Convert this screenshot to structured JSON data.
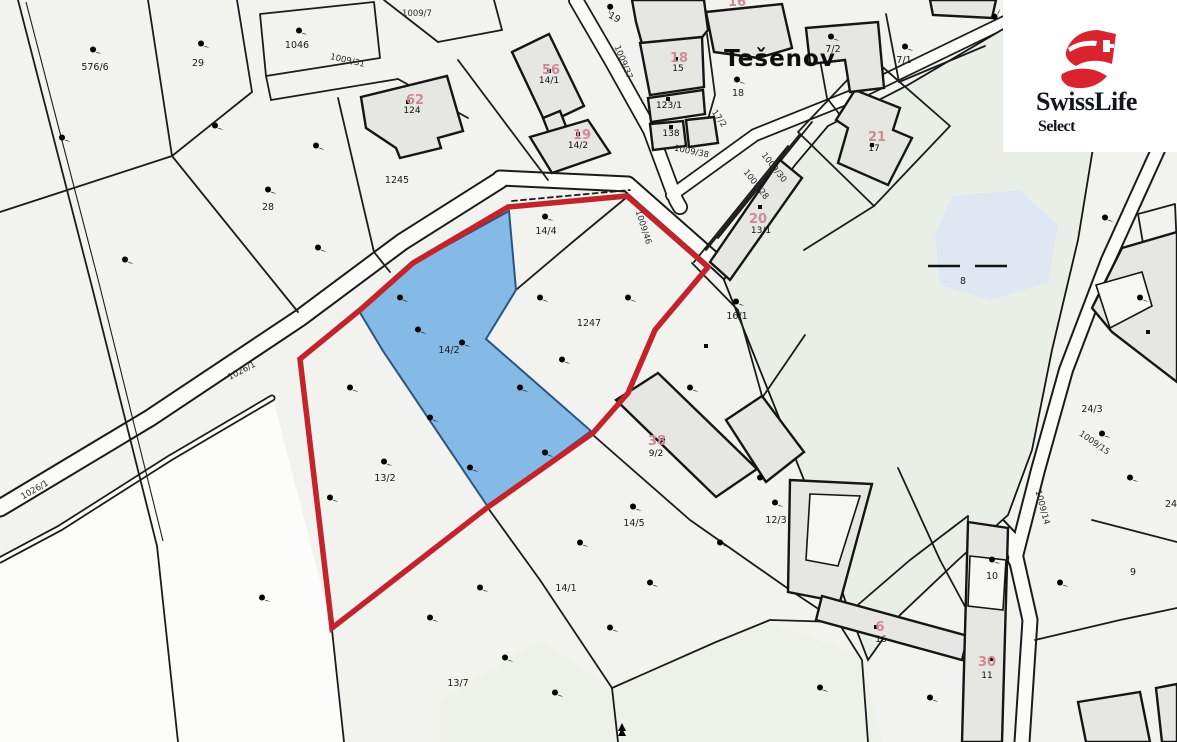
{
  "map": {
    "place_label": "Tešenov",
    "highlighted_parcel": "14/2",
    "colors": {
      "boundary_red": "#c3232a",
      "parcel_blue": "#85bae6",
      "building_gray": "#e6e6e3",
      "pond_green": "#e9efe7",
      "water_blue": "#dfe8f2",
      "background": "#f2f2ef"
    },
    "labels": [
      {
        "t": "576/6",
        "x": 95,
        "y": 70,
        "r": 0,
        "c": "lp"
      },
      {
        "t": "29",
        "x": 198,
        "y": 66,
        "r": 0,
        "c": "lp"
      },
      {
        "t": "1046",
        "x": 297,
        "y": 48,
        "r": 0,
        "c": "lp"
      },
      {
        "t": "28",
        "x": 268,
        "y": 210,
        "r": 0,
        "c": "lp"
      },
      {
        "t": "1245",
        "x": 397,
        "y": 183,
        "r": 0,
        "c": "lp"
      },
      {
        "t": "19",
        "x": 613,
        "y": 20,
        "r": 30,
        "c": "lp"
      },
      {
        "t": "18",
        "x": 738,
        "y": 96,
        "r": 0,
        "c": "lp"
      },
      {
        "t": "7/2",
        "x": 833,
        "y": 52,
        "r": 0,
        "c": "lp"
      },
      {
        "t": "7/1",
        "x": 904,
        "y": 63,
        "r": 0,
        "c": "lp"
      },
      {
        "t": "14/4",
        "x": 546,
        "y": 234,
        "r": 0,
        "c": "lp"
      },
      {
        "t": "1247",
        "x": 589,
        "y": 326,
        "r": 0,
        "c": "lp"
      },
      {
        "t": "14/2",
        "x": 449,
        "y": 353,
        "r": 0,
        "c": "lp"
      },
      {
        "t": "16/1",
        "x": 737,
        "y": 319,
        "r": 0,
        "c": "lp"
      },
      {
        "t": "13/2",
        "x": 385,
        "y": 481,
        "r": 0,
        "c": "lp"
      },
      {
        "t": "14/5",
        "x": 634,
        "y": 526,
        "r": 0,
        "c": "lp"
      },
      {
        "t": "12/3",
        "x": 776,
        "y": 523,
        "r": 0,
        "c": "lp"
      },
      {
        "t": "14/1",
        "x": 566,
        "y": 591,
        "r": 0,
        "c": "lp"
      },
      {
        "t": "13/7",
        "x": 458,
        "y": 686,
        "r": 0,
        "c": "lp"
      },
      {
        "t": "8",
        "x": 963,
        "y": 284,
        "r": 0,
        "c": "lp"
      },
      {
        "t": "9",
        "x": 1133,
        "y": 575,
        "r": 0,
        "c": "lp"
      },
      {
        "t": "10",
        "x": 992,
        "y": 579,
        "r": 0,
        "c": "lp"
      },
      {
        "t": "24",
        "x": 1171,
        "y": 507,
        "r": 0,
        "c": "lp"
      },
      {
        "t": "24/3",
        "x": 1092,
        "y": 412,
        "r": 0,
        "c": "lp",
        "s": 7
      },
      {
        "t": "1009/31",
        "x": 347,
        "y": 63,
        "r": 13,
        "c": "lr"
      },
      {
        "t": "1009/7",
        "x": 417,
        "y": 16,
        "r": 0,
        "c": "lr"
      },
      {
        "t": "1009/37",
        "x": 621,
        "y": 63,
        "r": 68,
        "c": "lr"
      },
      {
        "t": "1009/38",
        "x": 691,
        "y": 154,
        "r": 12,
        "c": "lr"
      },
      {
        "t": "17/2",
        "x": 717,
        "y": 120,
        "r": 55,
        "c": "lr"
      },
      {
        "t": "1009/30",
        "x": 772,
        "y": 169,
        "r": 52,
        "c": "lr"
      },
      {
        "t": "1009/28",
        "x": 754,
        "y": 186,
        "r": 52,
        "c": "lr"
      },
      {
        "t": "1009/46",
        "x": 641,
        "y": 228,
        "r": 72,
        "c": "lr"
      },
      {
        "t": "1026/1",
        "x": 243,
        "y": 373,
        "r": -28,
        "c": "lr"
      },
      {
        "t": "1026/1",
        "x": 36,
        "y": 492,
        "r": -30,
        "c": "lr"
      },
      {
        "t": "1009/15",
        "x": 1093,
        "y": 445,
        "r": 35,
        "c": "lr"
      },
      {
        "t": "1009/14",
        "x": 1040,
        "y": 508,
        "r": 75,
        "c": "lr"
      },
      {
        "t": "124",
        "x": 412,
        "y": 113,
        "r": 0,
        "c": "lbb"
      },
      {
        "t": "14/1",
        "x": 549,
        "y": 83,
        "r": 0,
        "c": "lbb"
      },
      {
        "t": "14/2",
        "x": 578,
        "y": 148,
        "r": 0,
        "c": "lbb"
      },
      {
        "t": "15",
        "x": 678,
        "y": 71,
        "r": 0,
        "c": "lbb"
      },
      {
        "t": "123/1",
        "x": 669,
        "y": 108,
        "r": 0,
        "c": "lbb"
      },
      {
        "t": "138",
        "x": 671,
        "y": 136,
        "r": 0,
        "c": "lbb"
      },
      {
        "t": "13/1",
        "x": 761,
        "y": 233,
        "r": 0,
        "c": "lbb"
      },
      {
        "t": "17",
        "x": 874,
        "y": 151,
        "r": 0,
        "c": "lbb"
      },
      {
        "t": "9/2",
        "x": 656,
        "y": 456,
        "r": 0,
        "c": "lbb"
      },
      {
        "t": "16",
        "x": 881,
        "y": 642,
        "r": 0,
        "c": "lbb"
      },
      {
        "t": "11",
        "x": 987,
        "y": 678,
        "r": 0,
        "c": "lbb"
      },
      {
        "t": "62",
        "x": 415,
        "y": 104,
        "r": 0,
        "c": "lbr",
        "s": 12
      },
      {
        "t": "56",
        "x": 551,
        "y": 74,
        "r": 0,
        "c": "lbr",
        "s": 13
      },
      {
        "t": "19",
        "x": 582,
        "y": 139,
        "r": 0,
        "c": "lbr",
        "s": 13
      },
      {
        "t": "18",
        "x": 679,
        "y": 62,
        "r": 0,
        "c": "lbr",
        "s": 12
      },
      {
        "t": "16",
        "x": 737,
        "y": 6,
        "r": 0,
        "c": "lbr",
        "s": 12
      },
      {
        "t": "20",
        "x": 758,
        "y": 223,
        "r": 0,
        "c": "lbr",
        "s": 12
      },
      {
        "t": "21",
        "x": 877,
        "y": 141,
        "r": 0,
        "c": "lbr",
        "s": 19
      },
      {
        "t": "38",
        "x": 657,
        "y": 445,
        "r": 0,
        "c": "lbr",
        "s": 17
      },
      {
        "t": "6",
        "x": 880,
        "y": 631,
        "r": 0,
        "c": "lbr",
        "s": 12
      },
      {
        "t": "30",
        "x": 987,
        "y": 666,
        "r": 0,
        "c": "lbr",
        "s": 15
      },
      {
        "t": "Tešenov",
        "x": 780,
        "y": 66,
        "r": 0,
        "c": "lpl"
      }
    ],
    "pasture_symbols": [
      [
        93,
        52,
        0
      ],
      [
        201,
        46,
        0
      ],
      [
        299,
        33,
        0
      ],
      [
        268,
        192,
        0
      ],
      [
        608,
        8,
        60
      ],
      [
        737,
        82,
        0
      ],
      [
        831,
        39,
        0
      ],
      [
        905,
        49,
        0
      ],
      [
        545,
        219,
        0
      ],
      [
        384,
        464,
        0
      ],
      [
        633,
        509,
        0
      ],
      [
        775,
        505,
        0
      ],
      [
        992,
        562,
        0
      ],
      [
        1102,
        436,
        0
      ],
      [
        736,
        304,
        0
      ],
      [
        997,
        17,
        -80
      ]
    ],
    "cross_symbols": [
      [
        745,
        41
      ],
      [
        769,
        41
      ]
    ],
    "bar_symbols": [
      [
        460,
        668
      ],
      [
        1089,
        401
      ]
    ],
    "building_dots": [
      [
        408,
        102
      ],
      [
        549,
        71
      ],
      [
        578,
        134
      ],
      [
        676,
        59
      ],
      [
        668,
        99
      ],
      [
        671,
        127
      ],
      [
        760,
        207
      ],
      [
        872,
        145
      ],
      [
        663,
        440
      ],
      [
        876,
        627
      ],
      [
        991,
        659
      ],
      [
        706,
        346
      ],
      [
        1148,
        332
      ]
    ],
    "water_dashes": [
      [
        928,
        266,
        960,
        266
      ],
      [
        975,
        266,
        1007,
        266
      ]
    ],
    "watermarks": [
      [
        62,
        140
      ],
      [
        125,
        262
      ],
      [
        215,
        128
      ],
      [
        316,
        148
      ],
      [
        318,
        250
      ],
      [
        418,
        332
      ],
      [
        350,
        390
      ],
      [
        330,
        500
      ],
      [
        262,
        600
      ],
      [
        430,
        620
      ],
      [
        505,
        660
      ],
      [
        580,
        545
      ],
      [
        650,
        585
      ],
      [
        720,
        545
      ],
      [
        760,
        480
      ],
      [
        690,
        390
      ],
      [
        562,
        362
      ],
      [
        628,
        300
      ],
      [
        540,
        300
      ],
      [
        1105,
        220
      ],
      [
        1140,
        300
      ],
      [
        1130,
        480
      ],
      [
        1060,
        585
      ],
      [
        930,
        700
      ],
      [
        820,
        690
      ],
      [
        480,
        590
      ],
      [
        610,
        630
      ],
      [
        555,
        695
      ]
    ],
    "pond_marks": [
      [
        878,
        170
      ],
      [
        1008,
        160
      ],
      [
        900,
        330
      ],
      [
        1020,
        360
      ],
      [
        950,
        470
      ],
      [
        880,
        520
      ],
      [
        1065,
        300
      ]
    ],
    "blue_watermarks": [
      [
        400,
        300
      ],
      [
        462,
        345
      ],
      [
        520,
        390
      ],
      [
        430,
        420
      ],
      [
        545,
        455
      ],
      [
        470,
        470
      ]
    ]
  },
  "logo": {
    "brand": "SwissLife",
    "sub": "Select",
    "accent": "#d9232e",
    "text_color": "#15151f"
  }
}
